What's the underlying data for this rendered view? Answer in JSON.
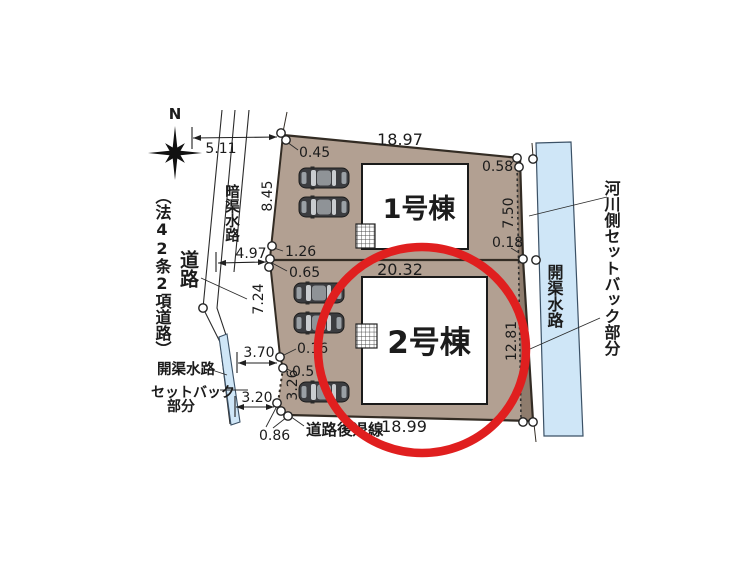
{
  "plan": {
    "compass_label": "N",
    "labels": {
      "law_road": "（法42条2項道路）",
      "road": "道路",
      "culvert": "暗渠水路",
      "open_channel_left": "開渠水路",
      "setback_l1": "セットバック",
      "setback_l2": "部分",
      "road_setback_line": "道路後退線",
      "river_setback": "河川側セットバック部分",
      "open_channel_right": "開渠水路",
      "unit1": "1号棟",
      "unit2": "2号棟"
    },
    "dims": {
      "road_width_top": "5.11",
      "corner_top": "0.45",
      "top_edge": "18.97",
      "corner_top_right": "0.58",
      "right_upper": "7.50",
      "right_offset": "0.18",
      "left_upper_edge": "8.45",
      "road_width_mid": "4.97",
      "offset_1_26": "1.26",
      "offset_0_65": "0.65",
      "lot2_top_edge": "20.32",
      "left_lower_edge": "7.24",
      "right_lower": "12.81",
      "road_width_lower": "3.70",
      "offset_0_16": "0.16",
      "offset_0_57": "0.57",
      "edge_3_26": "3.26",
      "road_width_bottom": "3.20",
      "offset_0_86": "0.86",
      "bottom_edge": "18.99"
    },
    "colors": {
      "lot_fill": "#b2a092",
      "setback_strip": "#8e7c6d",
      "water": "#cfe6f7",
      "highlight_red": "#e01f1f"
    }
  }
}
